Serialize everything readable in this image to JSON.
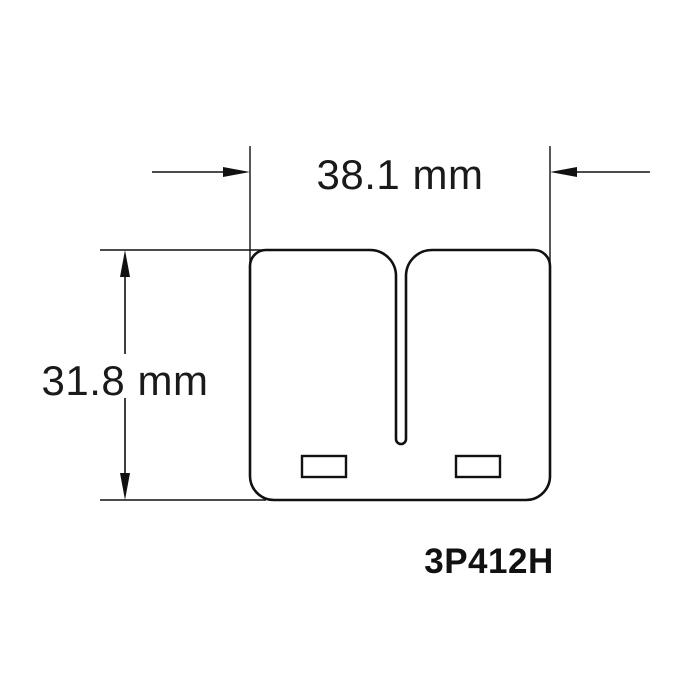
{
  "drawing": {
    "type": "technical-dimension-diagram",
    "part_number": "3P412H",
    "width_dimension": {
      "label": "38.1 mm",
      "value_mm": 38.1
    },
    "height_dimension": {
      "label": "31.8 mm",
      "value_mm": 31.8
    },
    "colors": {
      "line": "#111111",
      "text": "#1a1a1a",
      "background": "#ffffff"
    }
  }
}
